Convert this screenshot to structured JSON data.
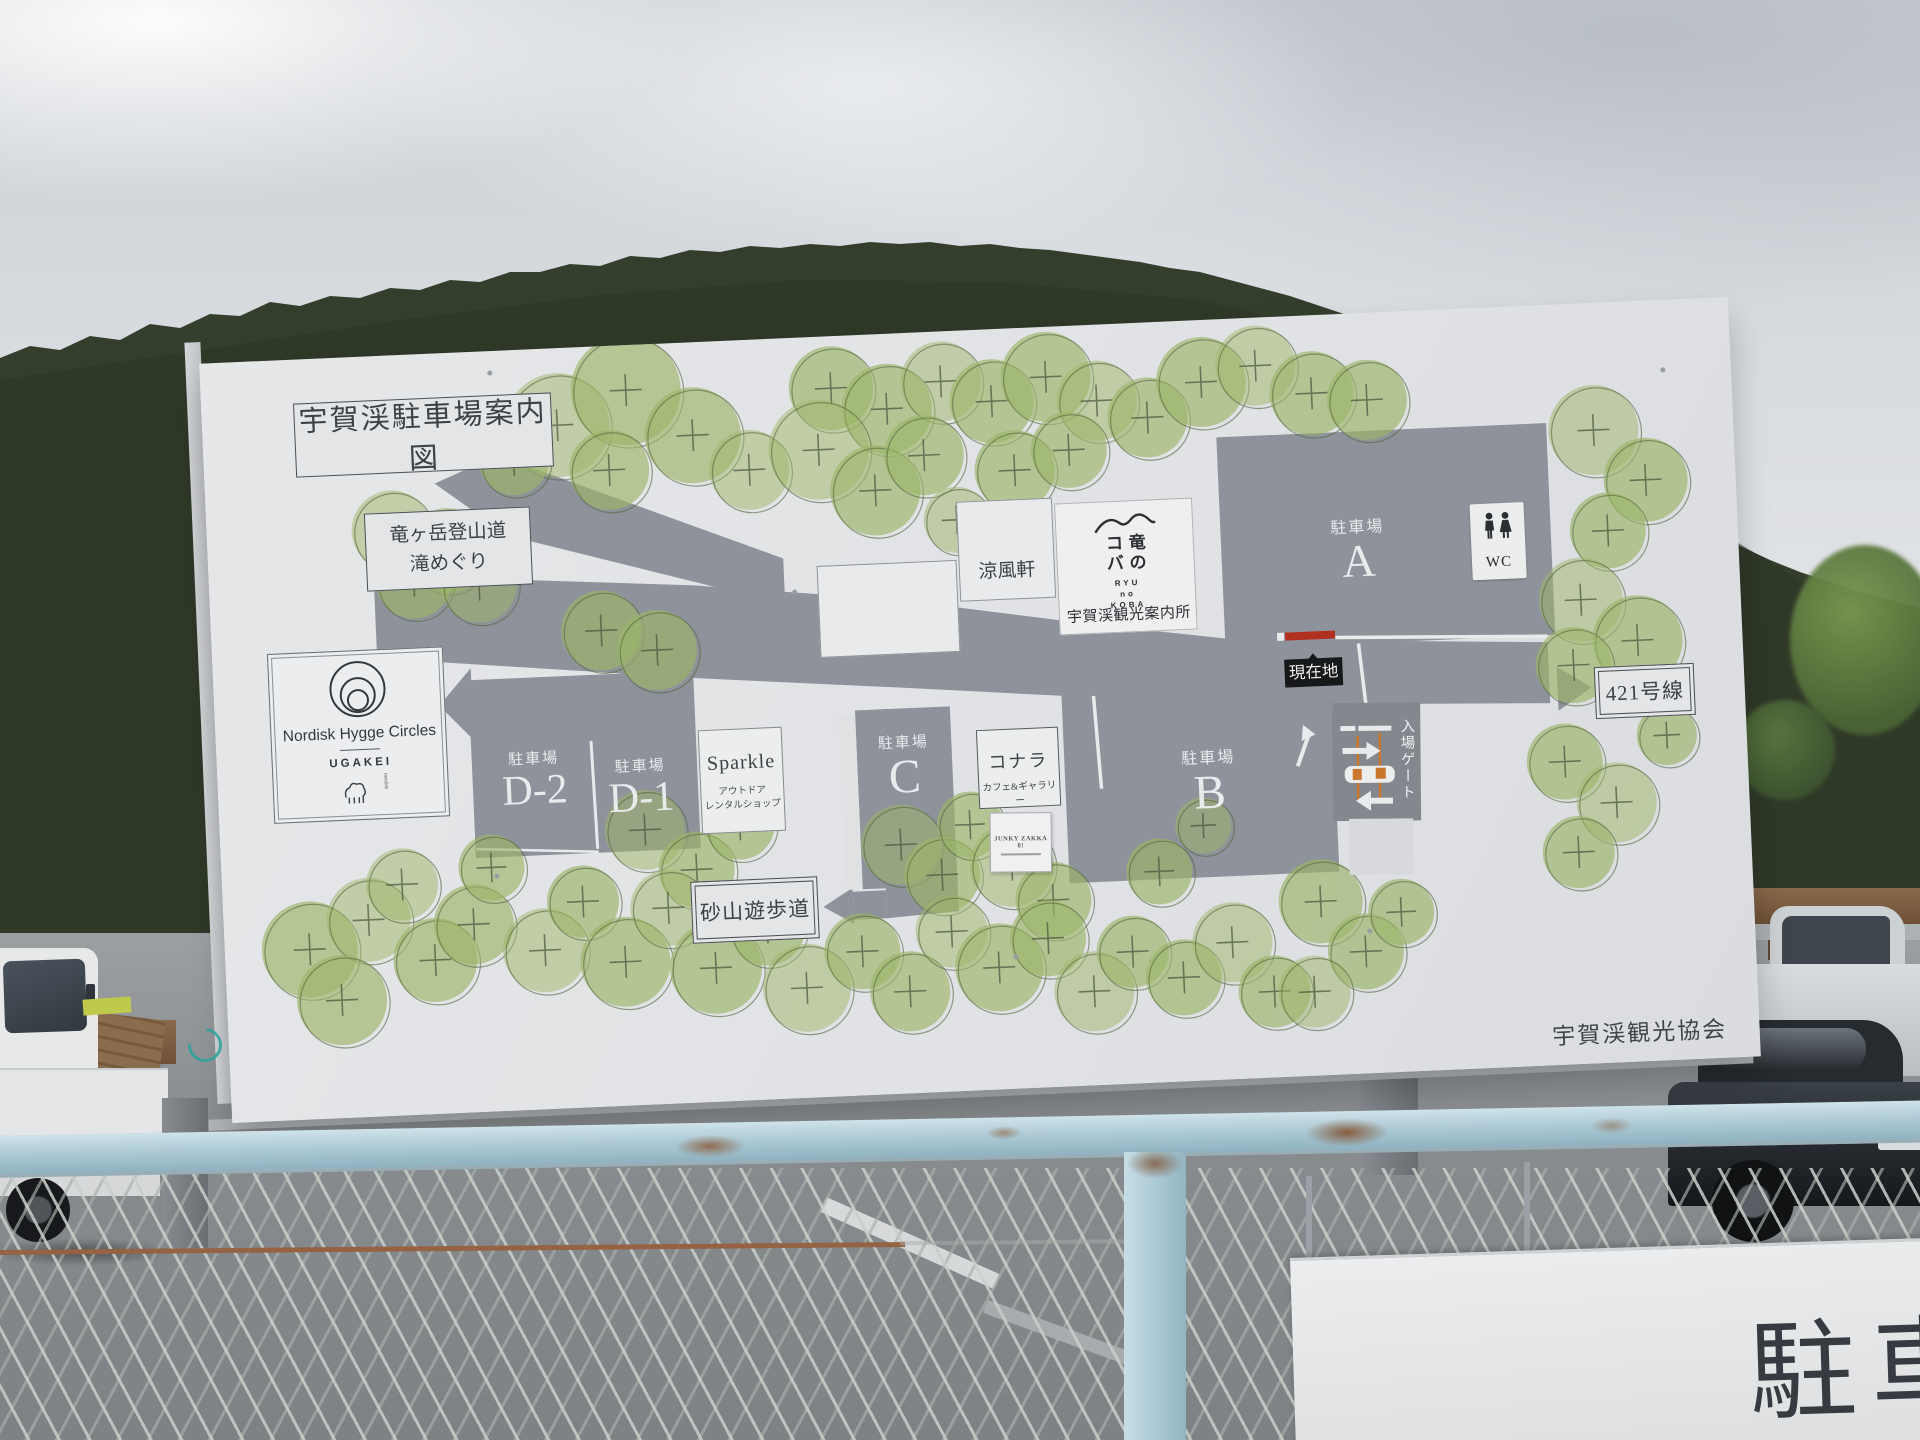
{
  "map": {
    "title": "宇賀渓駐車場案内図",
    "colors": {
      "tree_green": "#9db568",
      "road_gray": "#8e929a",
      "current_location_red": "#b23020",
      "gate_orange": "#c9772c",
      "fence_blue": "#a7c6d2"
    },
    "labels": {
      "trail_line1": "竜ヶ岳登山道",
      "trail_line2": "滝めぐり",
      "ryofuken": "涼風軒",
      "info_center": "宇賀渓観光案内所",
      "parking_word": "駐車場",
      "lot_a": "A",
      "lot_b": "B",
      "lot_c": "C",
      "lot_d1": "D-1",
      "lot_d2": "D-2",
      "wc": "WC",
      "current_location": "現在地",
      "route_421": "421号線",
      "gate": "入場ゲート",
      "sunayama": "砂山遊歩道",
      "association": "宇賀渓観光協会"
    },
    "ryunokoba": {
      "col_right": "竜の",
      "col_left": "コバ",
      "latin1": "RYU",
      "latin2": "no",
      "latin3": "KOBA"
    },
    "nordisk": {
      "name": "Nordisk Hygge Circles",
      "sub": "UGAKEI",
      "brand": "nordisk"
    },
    "sparkle": {
      "name": "Sparkle",
      "sub1": "アウトドア",
      "sub2": "レンタルショップ"
    },
    "konara": {
      "name": "コナラ",
      "sub": "カフェ&ギャラリー"
    },
    "junky": {
      "name": "JUNKY ZAKKA 8!"
    },
    "trees": [
      [
        355,
        77,
        52
      ],
      [
        425,
        45,
        55
      ],
      [
        490,
        93,
        48
      ],
      [
        545,
        130,
        40
      ],
      [
        405,
        124,
        40
      ],
      [
        310,
        110,
        35
      ],
      [
        265,
        78,
        30
      ],
      [
        630,
        52,
        42
      ],
      [
        685,
        75,
        45
      ],
      [
        740,
        50,
        40
      ],
      [
        790,
        72,
        42
      ],
      [
        845,
        50,
        45
      ],
      [
        895,
        76,
        40
      ],
      [
        945,
        95,
        40
      ],
      [
        1000,
        62,
        45
      ],
      [
        1055,
        48,
        40
      ],
      [
        1110,
        78,
        42
      ],
      [
        1165,
        87,
        40
      ],
      [
        1390,
        127,
        45
      ],
      [
        1440,
        179,
        42
      ],
      [
        1400,
        228,
        38
      ],
      [
        615,
        113,
        50
      ],
      [
        670,
        156,
        45
      ],
      [
        720,
        123,
        40
      ],
      [
        750,
        189,
        33
      ],
      [
        810,
        142,
        40
      ],
      [
        865,
        124,
        38
      ],
      [
        185,
        175,
        40
      ],
      [
        240,
        197,
        42
      ],
      [
        205,
        226,
        38
      ],
      [
        270,
        233,
        38
      ],
      [
        390,
        284,
        40
      ],
      [
        445,
        306,
        40
      ],
      [
        1370,
        296,
        42
      ],
      [
        1425,
        339,
        45
      ],
      [
        1360,
        361,
        38
      ],
      [
        425,
        485,
        40
      ],
      [
        475,
        527,
        38
      ],
      [
        520,
        484,
        35
      ],
      [
        680,
        511,
        40
      ],
      [
        720,
        543,
        38
      ],
      [
        750,
        494,
        33
      ],
      [
        790,
        536,
        42
      ],
      [
        830,
        573,
        38
      ],
      [
        85,
        590,
        48
      ],
      [
        145,
        563,
        42
      ],
      [
        115,
        642,
        45
      ],
      [
        210,
        606,
        42
      ],
      [
        180,
        529,
        36
      ],
      [
        250,
        572,
        40
      ],
      [
        270,
        516,
        33
      ],
      [
        320,
        601,
        42
      ],
      [
        360,
        554,
        36
      ],
      [
        400,
        616,
        45
      ],
      [
        445,
        564,
        38
      ],
      [
        490,
        626,
        46
      ],
      [
        543,
        588,
        38
      ],
      [
        580,
        650,
        44
      ],
      [
        637,
        616,
        38
      ],
      [
        683,
        658,
        40
      ],
      [
        727,
        600,
        36
      ],
      [
        773,
        638,
        44
      ],
      [
        823,
        611,
        38
      ],
      [
        867,
        666,
        40
      ],
      [
        907,
        628,
        36
      ],
      [
        957,
        656,
        38
      ],
      [
        1007,
        623,
        40
      ],
      [
        1047,
        674,
        36
      ],
      [
        937,
        549,
        33
      ],
      [
        983,
        505,
        28
      ],
      [
        1097,
        586,
        42
      ],
      [
        1140,
        638,
        38
      ],
      [
        1087,
        676,
        36
      ],
      [
        1177,
        600,
        33
      ],
      [
        1347,
        457,
        38
      ],
      [
        1397,
        500,
        40
      ],
      [
        1357,
        548,
        36
      ],
      [
        1450,
        435,
        30
      ]
    ]
  },
  "photo": {
    "parking_sign_text": "駐車"
  }
}
